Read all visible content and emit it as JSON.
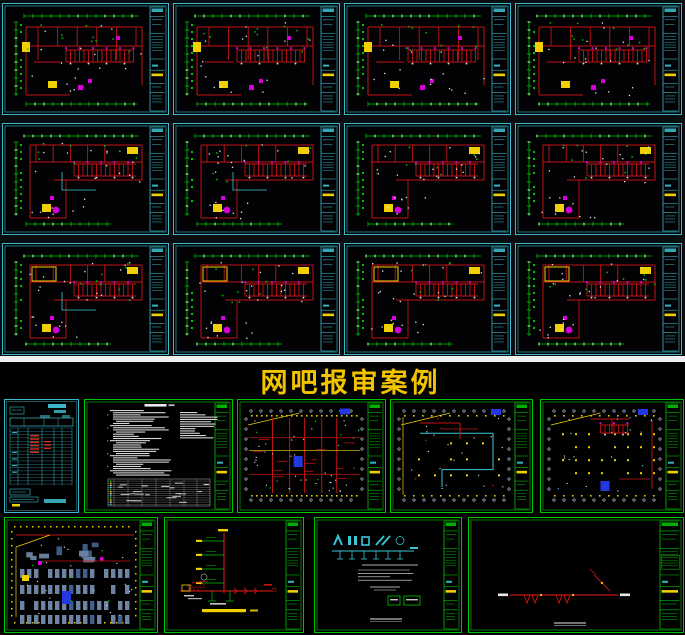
{
  "title": {
    "text": "网吧报审案例",
    "color": "#f2c400"
  },
  "palette": {
    "cyan": "#3db8c8",
    "cyan_bright": "#39c7d8",
    "green": "#00c300",
    "red": "#c41414",
    "yellow": "#f0d000",
    "magenta": "#d800d8",
    "blue": "#2438e0",
    "white": "#e9e9e9",
    "gray_blue": "#6e84a2",
    "gray_blue_dark": "#41608c",
    "bubble_gray": "#b8c0cc",
    "bg_top": "#0a0d11",
    "bg_bottom": "#000000",
    "divider": "#efefef",
    "sheet_bg": "#020205"
  },
  "top_section": {
    "description": "12 CAD electrical floor-plan sheets, cyan sheet frames, 3 rows x 4 columns",
    "sheets": [
      {
        "id": "plan-r1c1",
        "kind": "floor-plan",
        "variant": 0,
        "seed": 11
      },
      {
        "id": "plan-r1c2",
        "kind": "floor-plan",
        "variant": 0,
        "seed": 12
      },
      {
        "id": "plan-r1c3",
        "kind": "floor-plan",
        "variant": 0,
        "seed": 13
      },
      {
        "id": "plan-r1c4",
        "kind": "floor-plan",
        "variant": 0,
        "seed": 14
      },
      {
        "id": "plan-r2c1",
        "kind": "floor-plan",
        "variant": 1,
        "seed": 15
      },
      {
        "id": "plan-r2c2",
        "kind": "floor-plan",
        "variant": 1,
        "seed": 16
      },
      {
        "id": "plan-r2c3",
        "kind": "floor-plan",
        "variant": 1,
        "seed": 17
      },
      {
        "id": "plan-r2c4",
        "kind": "floor-plan",
        "variant": 1,
        "seed": 18
      },
      {
        "id": "plan-r3c1",
        "kind": "floor-plan",
        "variant": 2,
        "seed": 19
      },
      {
        "id": "plan-r3c2",
        "kind": "floor-plan",
        "variant": 2,
        "seed": 20
      },
      {
        "id": "plan-r3c3",
        "kind": "floor-plan",
        "variant": 2,
        "seed": 21
      },
      {
        "id": "plan-r3c4",
        "kind": "floor-plan",
        "variant": 2,
        "seed": 22
      }
    ]
  },
  "bottom_section": {
    "description": "internet-cafe submittal set: drawing list, design notes, plans and diagrams, green sheet frames",
    "row1": [
      {
        "id": "drawing-list",
        "kind": "drawing-list-table",
        "seed": 31
      },
      {
        "id": "design-notes",
        "kind": "design-notes",
        "seed": 32
      },
      {
        "id": "plan-a",
        "kind": "green-plan",
        "style": "dense",
        "seed": 33
      },
      {
        "id": "plan-b",
        "kind": "green-plan",
        "style": "loop",
        "seed": 34
      },
      {
        "id": "plan-c",
        "kind": "green-plan",
        "style": "dots",
        "seed": 35
      }
    ],
    "row2": [
      {
        "id": "furniture-plan",
        "kind": "furniture-plan",
        "seed": 36
      },
      {
        "id": "riser-diagram",
        "kind": "riser-diagram",
        "seed": 37
      },
      {
        "id": "system-schematic",
        "kind": "system-schematic",
        "seed": 38
      },
      {
        "id": "line-diagram",
        "kind": "line-diagram",
        "seed": 39
      }
    ]
  }
}
